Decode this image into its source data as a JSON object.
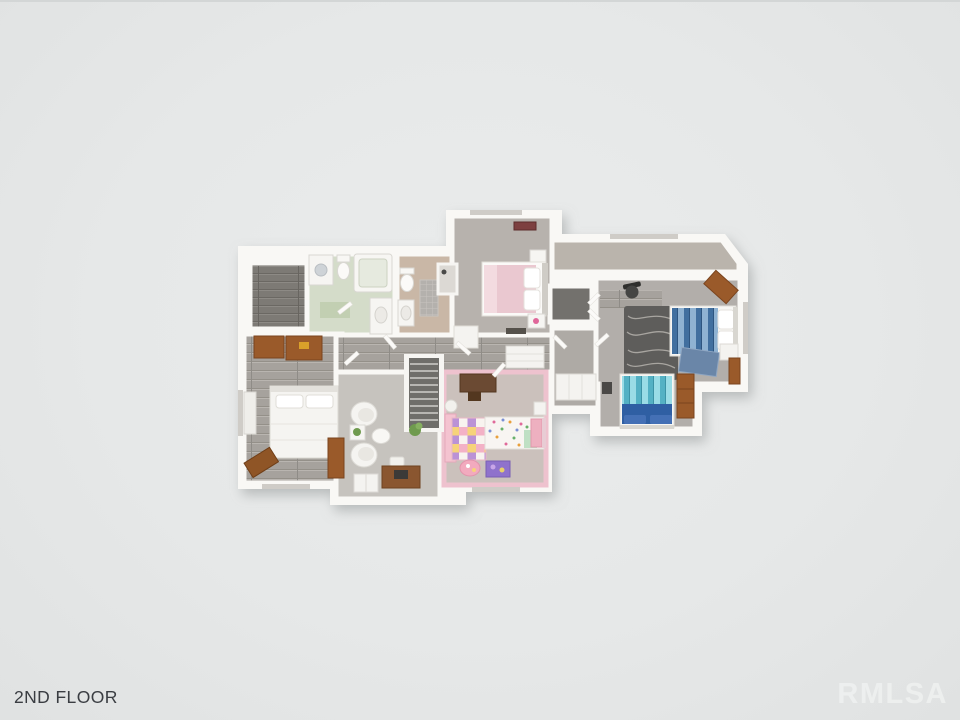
{
  "image": {
    "type": "3D floor plan render",
    "floor_label": "2ND FLOOR",
    "watermark": "RMLSA"
  },
  "palette": {
    "background": "#e6e8e8",
    "wall_white": "#f9f8f5",
    "label_text": "#3a3d42",
    "watermark_text": "#f0f2f1",
    "wood_plank_floor": "#a6a29d",
    "dark_wood_floor": "#7d7a75",
    "carpet_gray": "#b2aeaa",
    "den_floor": "#c6c3be",
    "kids_floor": "#cbc1bc",
    "kids_wall_pink": "#eec2ce",
    "bath_green_floor": "#d4dcc9",
    "bath_tan_floor": "#c9b7a6",
    "furniture_wood": "#9a5a2a",
    "pink_bed": "#eac8d0",
    "blue_bed_stripe": "#416f9f",
    "aqua_bed_stripe": "#54b1c4",
    "navy_duvet": "#2f5fa3",
    "dark_rug": "#5e5d5b",
    "stair_tread": "#6f6e6a"
  },
  "floorplan": {
    "floor_name": "2nd floor",
    "rooms": [
      "master-bedroom",
      "walk-in-closet",
      "laundry-bathroom",
      "hall-bathroom",
      "pink-bedroom",
      "kids-bedroom",
      "sitting-den",
      "bonus-bedroom",
      "upper-landing",
      "hallway",
      "staircase",
      "bonus-closet"
    ],
    "furniture": [
      "master-bed",
      "wood-dressers",
      "white-bench",
      "wood-bench",
      "washer",
      "toilet",
      "bathtub",
      "vanity-sink",
      "shower",
      "tile-rug",
      "pink-double-bed",
      "nightstand",
      "wall-art",
      "white-dresser",
      "armchairs",
      "plant-table",
      "round-table",
      "writing-desk",
      "laptop",
      "cabinet",
      "kids-desk",
      "play-mat",
      "kids-bed",
      "kids-pink-table",
      "purple-toy-box",
      "pink-dresser",
      "laundry-basket",
      "office-chair",
      "wavy-dark-rug",
      "blue-striped-bed",
      "aqua-striped-bed",
      "tall-dresser",
      "linen-closet",
      "closet-shelves"
    ]
  }
}
